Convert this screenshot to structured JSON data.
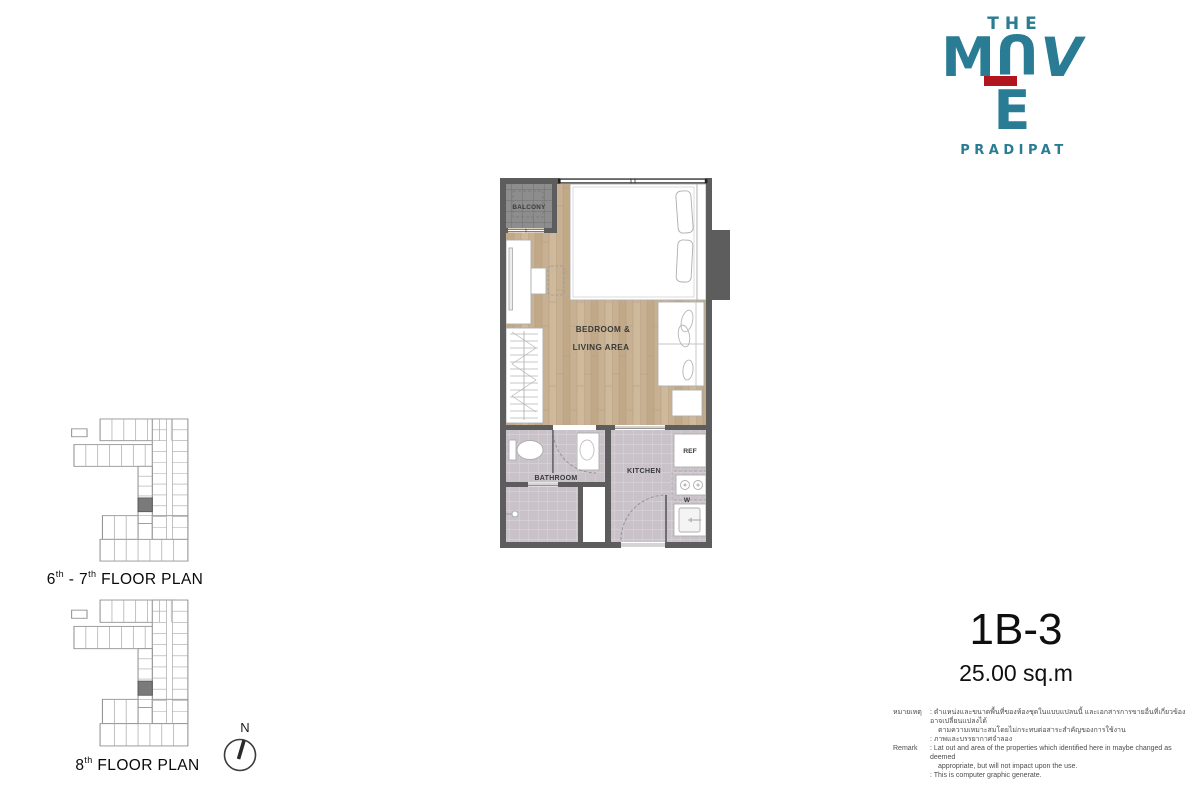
{
  "logo": {
    "the": "THE",
    "name_m": "M",
    "name_u": "U",
    "name_v": "V",
    "name_e": "E",
    "subtitle": "PRADIPAT",
    "teal": "#2a7b94",
    "red": "#b1161f"
  },
  "floor_plans": {
    "plan1": {
      "num1": "6",
      "sup1": "th",
      "joiner": " - 7",
      "sup2": "th",
      "rest": " FLOOR PLAN"
    },
    "plan2": {
      "num1": "8",
      "sup1": "th",
      "rest": " FLOOR PLAN"
    }
  },
  "compass": {
    "north": "N"
  },
  "unit_plan": {
    "labels": {
      "balcony": "BALCONY",
      "bedroom1": "BEDROOM &",
      "bedroom2": "LIVING AREA",
      "bathroom": "BATHROOM",
      "kitchen": "KITCHEN",
      "ref": "REF",
      "washer": "W"
    },
    "colors": {
      "wall": "#5d5d5d",
      "wood": "#c8b193",
      "tile": "#c9c2c8",
      "balcony_tile": "#8d8d8d"
    }
  },
  "unit_info": {
    "name": "1B-3",
    "area": "25.00 sq.m"
  },
  "remark": {
    "rows": [
      {
        "label": "หมายเหตุ",
        "text": ": ตำแหน่งและขนาดพื้นที่ของห้องชุดในแบบแปลนนี้ และเอกสารการขายอื่นที่เกี่ยวข้อง อาจเปลี่ยนแปลงได้"
      },
      {
        "label": "",
        "text": "ตามความเหมาะสมโดยไม่กระทบต่อสาระสำคัญของการใช้งาน"
      },
      {
        "label": "",
        "text": ": ภาพและบรรยากาศจำลอง"
      },
      {
        "label": "Remark",
        "text": ": Lat out and area of the properties which identified here in maybe changed as deemed"
      },
      {
        "label": "",
        "text": "appropriate,  but will not impact upon the use."
      },
      {
        "label": "",
        "text": ": This is computer graphic generate."
      }
    ]
  }
}
